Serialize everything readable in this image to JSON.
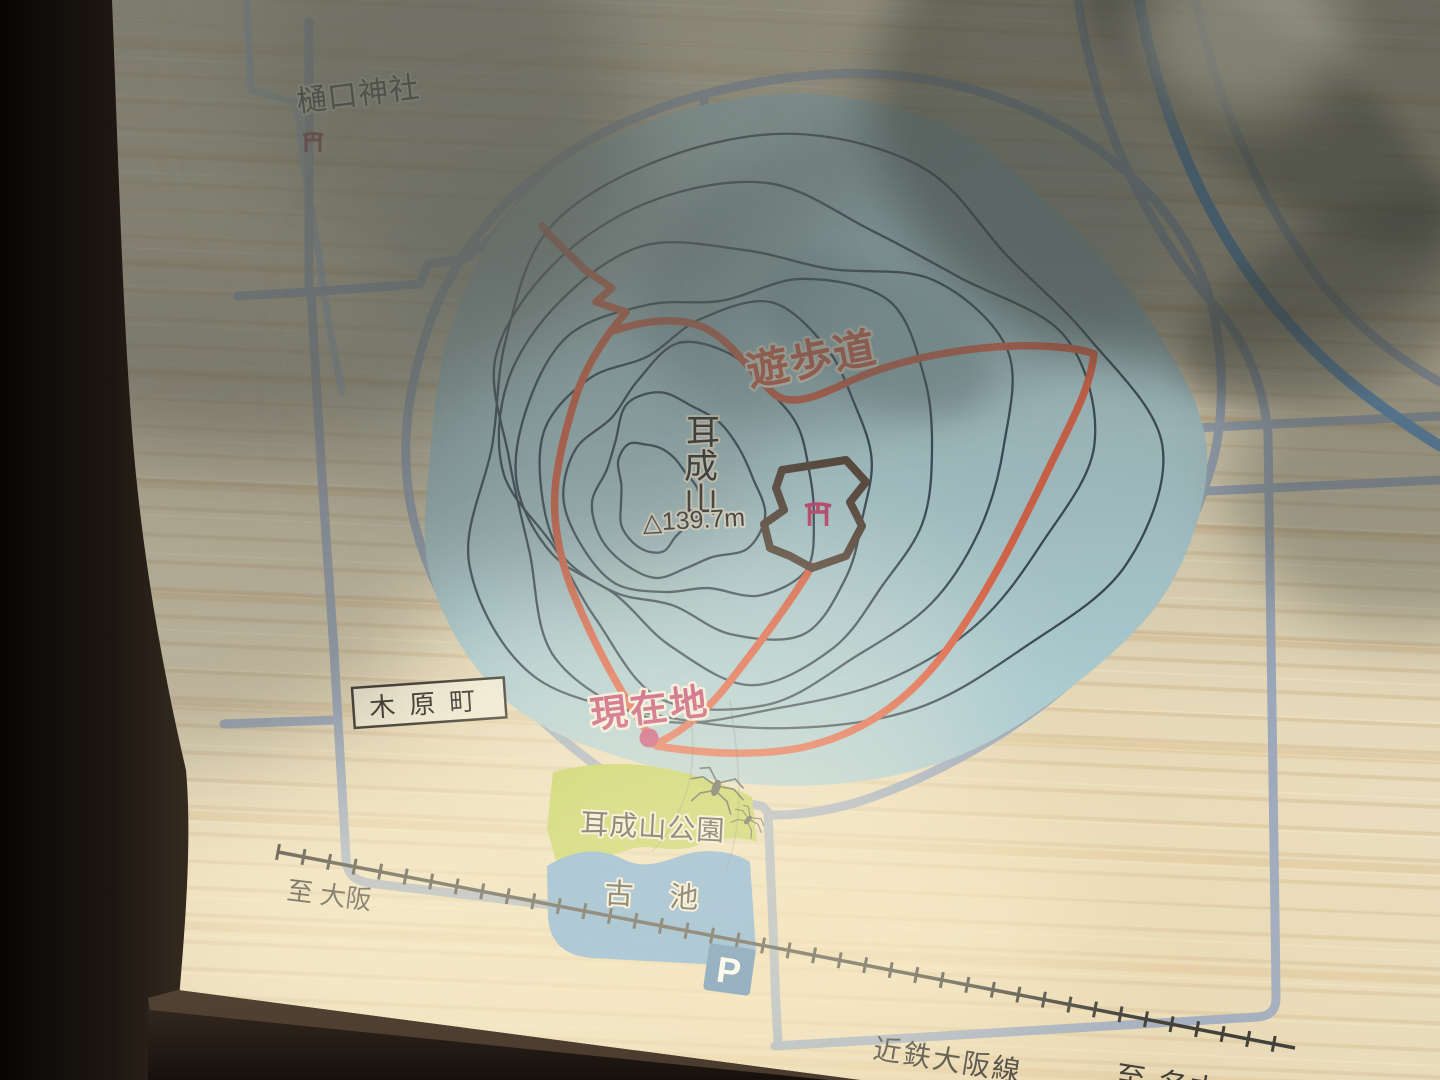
{
  "labels": {
    "higuchi_shrine": "樋口神社",
    "promenade": "遊歩道",
    "mountain": {
      "name": "耳成山",
      "chars": [
        "耳",
        "成",
        "山"
      ],
      "elevation": "△139.7m"
    },
    "current_location": "現在地",
    "kihara_town": "木原町",
    "park": "耳成山公園",
    "pond": "古池",
    "to_osaka": "至 大阪",
    "railway_line": "近鉄大阪線",
    "to_nagoya": "至 名古屋",
    "parking": "P"
  },
  "colors": {
    "trail": "#DE5A3C",
    "road": "#93A2BA",
    "stream": "#9FB6CE",
    "river": "#4F90D2",
    "mountain_fill": "#A8CAD1",
    "contour": "#1C2B3A",
    "park_green": "#B7C93F",
    "pond_blue": "#5B9BD3",
    "railway": "#22211E",
    "boundary_brown": "#4E3B30",
    "magenta": "#BE3465",
    "torii_red": "#93202C",
    "sign_blue": "#2E6CAB",
    "label_black": "#1E1C18"
  }
}
